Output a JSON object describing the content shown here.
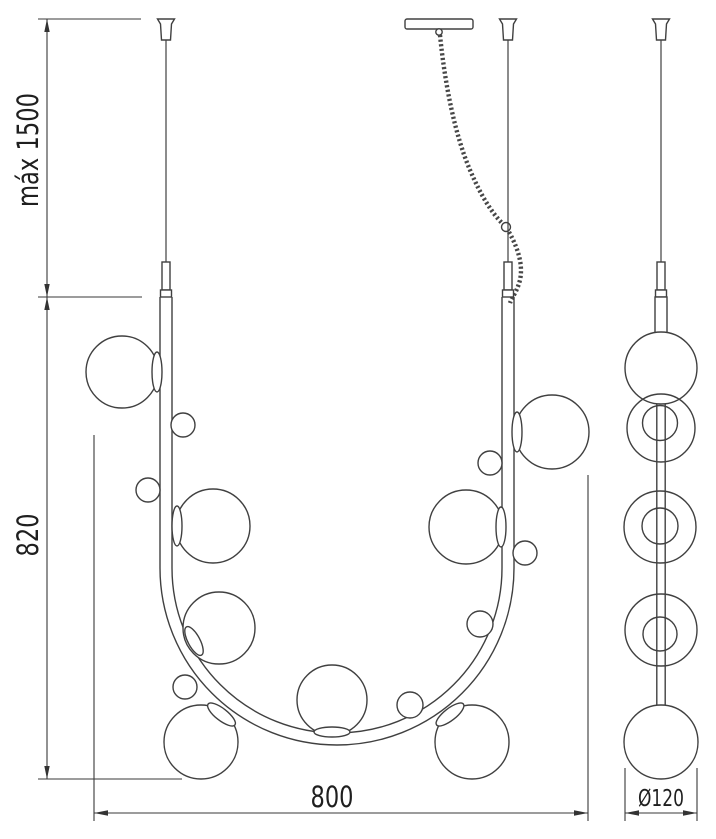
{
  "dimensions": {
    "max_suspension": "máx 1500",
    "fixture_height": "820",
    "fixture_width": "800",
    "globe_diameter": "Ø120"
  },
  "colors": {
    "line": "#404040",
    "dimension_line": "#3a3a3a",
    "text": "#1f1f1f",
    "background": "#ffffff"
  }
}
